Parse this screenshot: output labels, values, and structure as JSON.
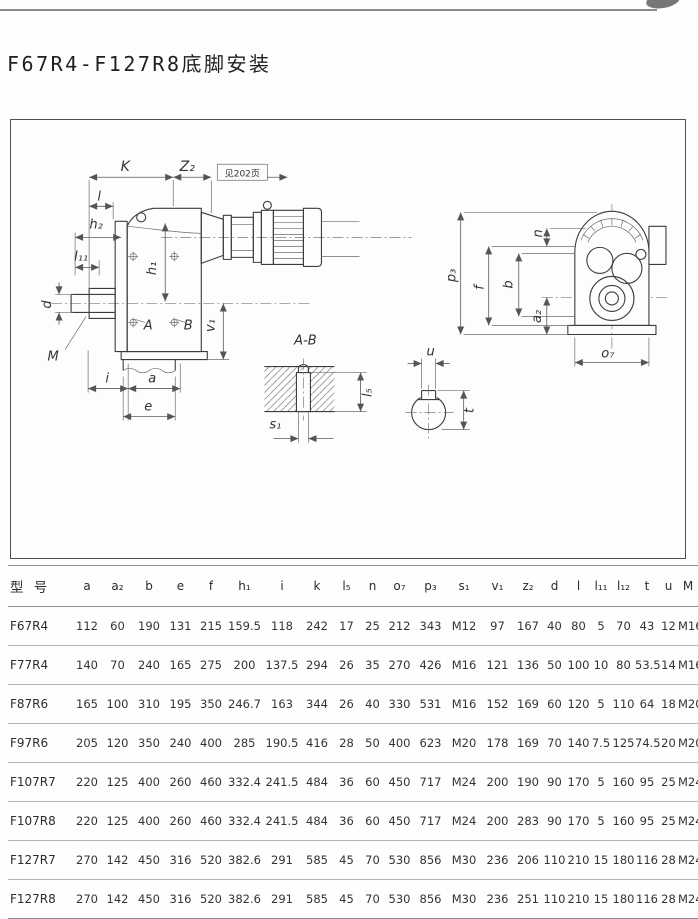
{
  "page": {
    "title": "F67R4-F127R8底脚安装"
  },
  "drawing": {
    "note": "见202页",
    "section_title": "A-B",
    "labels": {
      "K": "K",
      "z2": "Z₂",
      "l": "l",
      "h2": "h₂",
      "l11": "l₁₁",
      "d": "d",
      "M": "M",
      "h1": "h₁",
      "A": "A",
      "B": "B",
      "v1": "v₁",
      "i": "i",
      "a": "a",
      "e": "e",
      "s1": "s₁",
      "l5": "l₅",
      "u": "u",
      "t": "t",
      "p3": "p₃",
      "f": "f",
      "b": "b",
      "n": "n",
      "a2": "a₂",
      "o7": "o₇"
    }
  },
  "table": {
    "headers": [
      "型 号",
      "a",
      "a₂",
      "b",
      "e",
      "f",
      "h₁",
      "i",
      "k",
      "l₅",
      "n",
      "o₇",
      "p₃",
      "s₁",
      "v₁",
      "z₂",
      "d",
      "l",
      "l₁₁",
      "l₁₂",
      "t",
      "u",
      "M"
    ],
    "rows": [
      [
        "F67R4",
        "112",
        "60",
        "190",
        "131",
        "215",
        "159.5",
        "118",
        "242",
        "17",
        "25",
        "212",
        "343",
        "M12",
        "97",
        "167",
        "40",
        "80",
        "5",
        "70",
        "43",
        "12",
        "M16"
      ],
      [
        "F77R4",
        "140",
        "70",
        "240",
        "165",
        "275",
        "200",
        "137.5",
        "294",
        "26",
        "35",
        "270",
        "426",
        "M16",
        "121",
        "136",
        "50",
        "100",
        "10",
        "80",
        "53.5",
        "14",
        "M16"
      ],
      [
        "F87R6",
        "165",
        "100",
        "310",
        "195",
        "350",
        "246.7",
        "163",
        "344",
        "26",
        "40",
        "330",
        "531",
        "M16",
        "152",
        "169",
        "60",
        "120",
        "5",
        "110",
        "64",
        "18",
        "M20"
      ],
      [
        "F97R6",
        "205",
        "120",
        "350",
        "240",
        "400",
        "285",
        "190.5",
        "416",
        "28",
        "50",
        "400",
        "623",
        "M20",
        "178",
        "169",
        "70",
        "140",
        "7.5",
        "125",
        "74.5",
        "20",
        "M20"
      ],
      [
        "F107R7",
        "220",
        "125",
        "400",
        "260",
        "460",
        "332.4",
        "241.5",
        "484",
        "36",
        "60",
        "450",
        "717",
        "M24",
        "200",
        "190",
        "90",
        "170",
        "5",
        "160",
        "95",
        "25",
        "M24"
      ],
      [
        "F107R8",
        "220",
        "125",
        "400",
        "260",
        "460",
        "332.4",
        "241.5",
        "484",
        "36",
        "60",
        "450",
        "717",
        "M24",
        "200",
        "283",
        "90",
        "170",
        "5",
        "160",
        "95",
        "25",
        "M24"
      ],
      [
        "F127R7",
        "270",
        "142",
        "450",
        "316",
        "520",
        "382.6",
        "291",
        "585",
        "45",
        "70",
        "530",
        "856",
        "M30",
        "236",
        "206",
        "110",
        "210",
        "15",
        "180",
        "116",
        "28",
        "M24"
      ],
      [
        "F127R8",
        "270",
        "142",
        "450",
        "316",
        "520",
        "382.6",
        "291",
        "585",
        "45",
        "70",
        "530",
        "856",
        "M30",
        "236",
        "251",
        "110",
        "210",
        "15",
        "180",
        "116",
        "28",
        "M24"
      ]
    ]
  }
}
